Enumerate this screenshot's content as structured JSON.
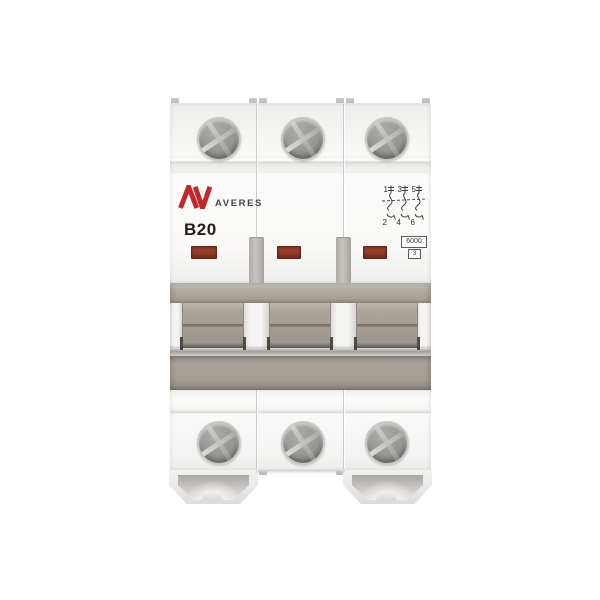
{
  "product": {
    "brand": "AVERES",
    "logo_monogram": "AV",
    "rating": "B20",
    "breaking_capacity": "6000",
    "energy_limiting_class": "3",
    "poles": 3
  },
  "schematic": {
    "top_terminals": [
      "1",
      "3",
      "5"
    ],
    "bottom_terminals": [
      "2",
      "4",
      "6"
    ]
  },
  "colors": {
    "brand_red": "#c1272d",
    "indicator_window_red": "#8c3a27",
    "handle_gray": "#a49e95",
    "body_white": "#fafaf9"
  }
}
